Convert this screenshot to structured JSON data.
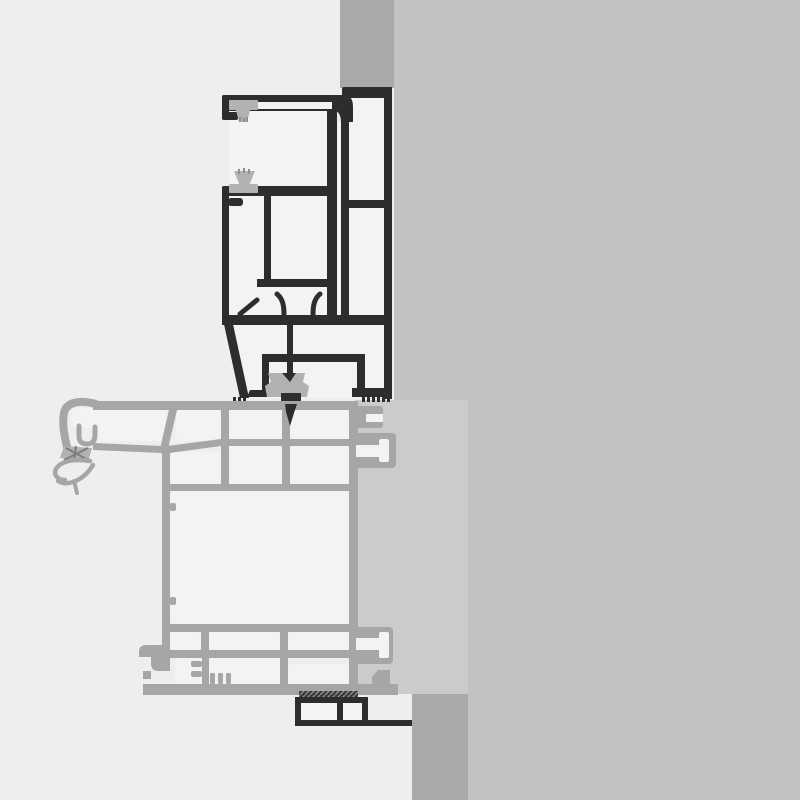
{
  "meta": {
    "kind": "technical-cross-section-drawing",
    "description": "CAD section detail: dark roller-shutter guide profile above a light-gray window frame profile, mounted against a wall shown as gray bands; no text labels visible"
  },
  "colors": {
    "bg_left": "#eeeeee",
    "band": "#c2c2c2",
    "strip": "#a9a9a9",
    "panel": "#cbcbcb",
    "column": "#a9a9a9",
    "ink": "#2d2d2d",
    "chamber": "#f3f3f3",
    "gray_wall": "#a6a6a6",
    "gasket": "#b2b2b2",
    "gasket_dark": "#8f8f8f",
    "hatch_dark": "#3a3a3a",
    "hatch_x": "#7d7d7d"
  },
  "drawing": {
    "parts": [
      {
        "name": "wall-strip-top",
        "color_key": "strip"
      },
      {
        "name": "wall-band-right",
        "color_key": "band"
      },
      {
        "name": "reveal-panel",
        "color_key": "panel"
      },
      {
        "name": "wall-column-bottom",
        "color_key": "column"
      },
      {
        "name": "dark-guide-profile",
        "color_key": "ink"
      },
      {
        "name": "brush-gasket-upper",
        "color_key": "gasket"
      },
      {
        "name": "brush-gasket-middle",
        "color_key": "gasket"
      },
      {
        "name": "rubber-gasket-lower",
        "color_key": "gasket"
      },
      {
        "name": "gray-frame-profile",
        "color_key": "gray_wall"
      },
      {
        "name": "frame-left-drip-claw",
        "color_key": "gray_wall"
      },
      {
        "name": "frame-right-tenons",
        "color_key": "gray_wall"
      },
      {
        "name": "bottom-angle-channel",
        "color_key": "ink"
      }
    ]
  }
}
